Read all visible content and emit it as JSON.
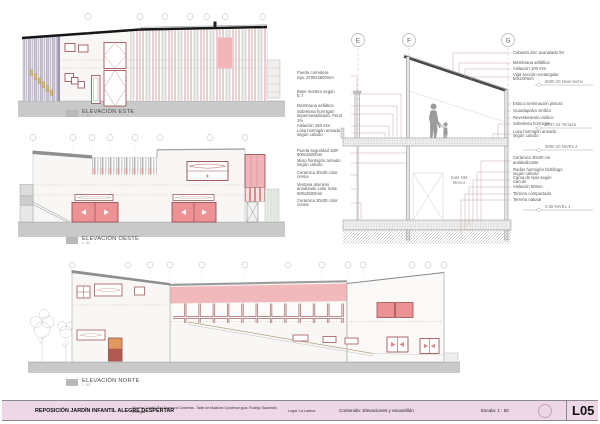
{
  "title_block": {
    "project": "REPOSICIÓN JARDÍN  INFANTIL ALEGRE DESPERTAR",
    "credits": "Alumno: Camila Paz Espinoza Contreras  -  Taller de titulación 3    profesor guía: Rodrigo Saavedra Venegas",
    "location": "Lugar: La Ladera",
    "content": "Contenido:   Elevaciones y escantillón",
    "scale": "Escala:    1 : 50",
    "sheet_number": "L05"
  },
  "elevations": {
    "east": {
      "label": "ELEVACIÓN ESTE",
      "scale": "1 : 50"
    },
    "west": {
      "label": "ELEVACIÓN OESTE",
      "scale": "1 : 50"
    },
    "north": {
      "label": "ELEVACIÓN NORTE",
      "scale": "1 : 50"
    }
  },
  "section": {
    "grid_bubbles": {
      "e": "E",
      "f": "F",
      "g": "G"
    },
    "room_label": "Sala NM\nMenor",
    "left_labels": [
      {
        "text": "Puerta corredera\nmja. 3700x2500mm"
      },
      {
        "text": "Base mortero según\nE.T"
      },
      {
        "text": "Membrana asfáltica"
      },
      {
        "text": "Sobrelosa hormigón\nimpermeabilizado. Pend 1%"
      },
      {
        "text": "Aislación 160 mm"
      },
      {
        "text": "Losa hormigón armada\nsegún calculo"
      },
      {
        "text": "Puerta seguridad 180º\n900x2500mm"
      },
      {
        "text": "Muro hormigón armado\nsegún calculo"
      },
      {
        "text": "Ceramica 30x30  color\ncrema"
      },
      {
        "text": "Ventana aluminio\nanodizado color mate\n900x2500mm"
      },
      {
        "text": "Ceramica 30x30 color\ncrema"
      }
    ],
    "right_labels": [
      {
        "text": "Cubierta zinc acanalado 5V"
      },
      {
        "text": "Membrana asfáltica"
      },
      {
        "text": "Aislación 100 mm"
      },
      {
        "text": "Viga sección rectangular\n50x100mm"
      },
      {
        "text": "Estuco terminación pintura"
      },
      {
        "text": "Guardapolvo vinílico"
      },
      {
        "text": "Revestimiento vinílico"
      },
      {
        "text": "Sobrelosa hormigón"
      },
      {
        "text": "Losa hormigón armado\nsegún calculo"
      },
      {
        "text": "Cerámico 30x30 cm\nantideslizante"
      },
      {
        "text": "Radier hormigón hidrófugo\nsegún cálculo"
      },
      {
        "text": "Cama de ripio según\ncálculo"
      },
      {
        "text": "Aislación 50mm"
      },
      {
        "text": "Terreno compactado"
      },
      {
        "text": "Terreno natural"
      }
    ],
    "level_markers": [
      {
        "text": "6000.20  Nivel techo"
      },
      {
        "text": "3747.41  Terraza"
      },
      {
        "text": "3000.20  NIVEL 2"
      },
      {
        "text": "0.00    NIVEL 1"
      }
    ]
  },
  "colors": {
    "accent_red_outline": "#a2585c",
    "door_pink": "#ec9194",
    "band_salmon": "#f2b9bd",
    "stripe_green": "#ccdccd",
    "stripe_lavender": "#d6d5e2",
    "ground_gray": "#c9c9c9",
    "roof_dark": "#161616",
    "titlebar_pink": "#eed7e7"
  }
}
